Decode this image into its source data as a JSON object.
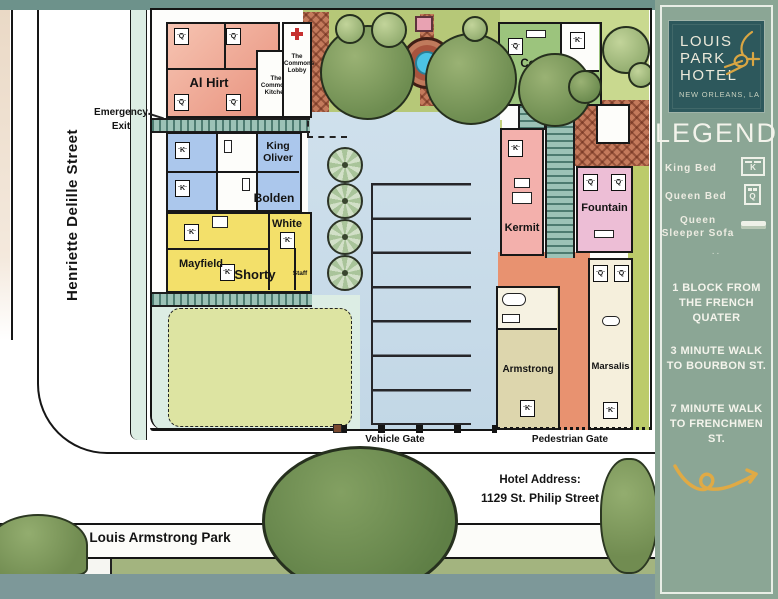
{
  "beds": {
    "k": "K",
    "q": "Q"
  },
  "map": {
    "street_left": "Henriette Delille Street",
    "park_sign": "Louis Armstrong Park",
    "emergency_exit": "Emergency Exit",
    "vehicle_gate": "Vehicle Gate",
    "pedestrian_gate": "Pedestrian Gate",
    "address_title": "Hotel Address:",
    "address_value": "1129 St. Philip Street",
    "buildings": {
      "al_hirt": "Al Hirt",
      "commons_kitchen": "The Commons Kitchen",
      "commons_lobby": "The Commons Lobby",
      "king_oliver": "King Oliver",
      "bolden": "Bolden",
      "white": "White",
      "mayfield": "Mayfield",
      "shorty": "Shorty",
      "staff": "Staff",
      "connick": "Connick",
      "kermit": "Kermit",
      "fountain": "Fountain",
      "armstrong": "Armstrong",
      "marsalis": "Marsalis"
    }
  },
  "panel": {
    "logo": {
      "name_lines": [
        "LOUIS",
        "PARK",
        "HOTEL"
      ],
      "subtitle": "NEW ORLEANS, LA"
    },
    "legend_title": "LEGEND:",
    "legend": [
      {
        "label": "King Bed"
      },
      {
        "label": "Queen Bed"
      },
      {
        "label": "Queen Sleeper Sofa"
      }
    ],
    "divider_dots": "..",
    "notes": [
      "1 BLOCK FROM THE FRENCH QUATER",
      "3 MINUTE WALK TO BOURBON ST.",
      "7 MINUTE WALK TO FRENCHMEN ST."
    ]
  },
  "colors": {
    "panel_bg": "#8ba695",
    "logo_bg": "#2d585c",
    "accent_gold": "#dfa944",
    "band_top": "#6d928b",
    "band_bottom": "#7d9899"
  }
}
